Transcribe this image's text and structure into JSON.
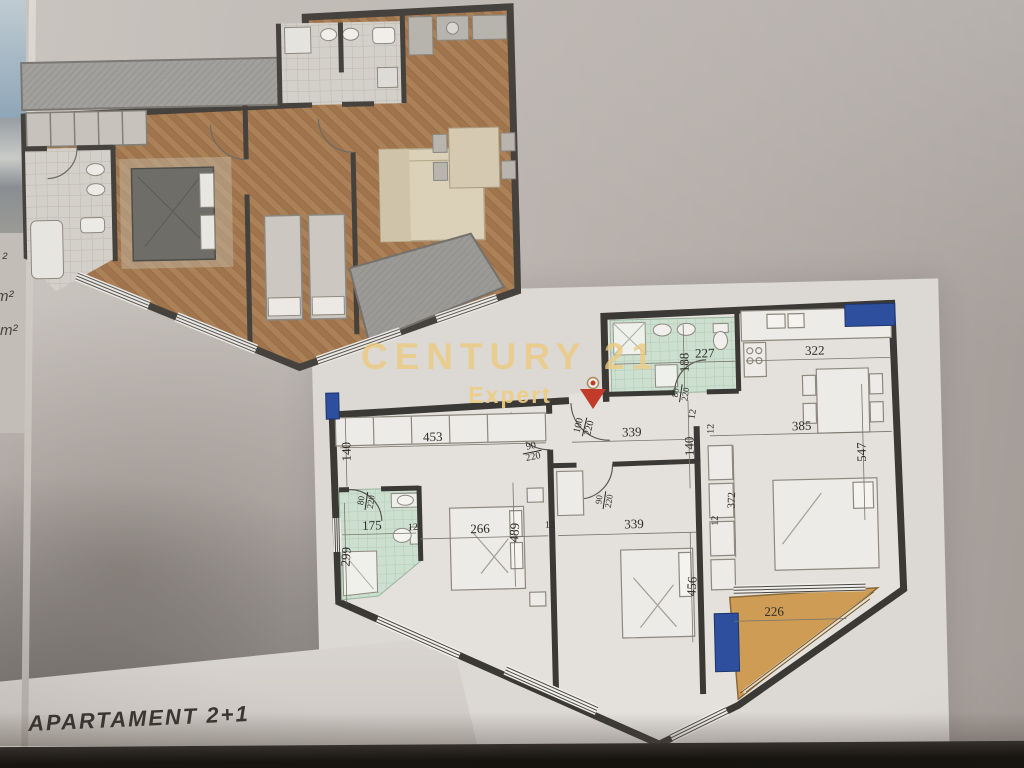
{
  "watermark": {
    "brand": "CENTURY 21",
    "sub": "Expert"
  },
  "caption": "APARTAMENT 2+1",
  "margin_labels": [
    {
      "t": "²",
      "x": 2,
      "y": 250
    },
    {
      "t": "m²",
      "x": -4,
      "y": 288
    },
    {
      "t": "m²",
      "x": 0,
      "y": 322
    }
  ],
  "colors": {
    "watermark_gold": "#eccb80",
    "logo_red": "#c13a2a",
    "marker_blue": "#2e4f9e",
    "balcony_tan": "#cf9c55",
    "bathroom_green": "#cde0d0",
    "wall_dark": "#3b3936",
    "wood_floor": "#ab8158"
  },
  "lower_plan": {
    "labels": [
      {
        "t": "453",
        "x": 113,
        "y": 134
      },
      {
        "t": "140",
        "x": 26,
        "y": 147,
        "r": -90
      },
      {
        "t": "90",
        "b": "220",
        "x": 212,
        "y": 152,
        "r": -10,
        "s": 10
      },
      {
        "t": "100",
        "b": "220",
        "x": 265,
        "y": 128,
        "r": -75,
        "s": 10
      },
      {
        "t": "339",
        "x": 312,
        "y": 134
      },
      {
        "t": "140",
        "x": 369,
        "y": 150,
        "r": -90
      },
      {
        "t": "12",
        "x": 392,
        "y": 133,
        "r": -90,
        "s": 10
      },
      {
        "t": "227",
        "x": 387,
        "y": 57
      },
      {
        "t": "188",
        "x": 366,
        "y": 66,
        "r": -90
      },
      {
        "t": "80",
        "b": "220",
        "x": 362,
        "y": 97,
        "r": -80,
        "s": 9
      },
      {
        "t": "12",
        "x": 374,
        "y": 118,
        "r": -80,
        "s": 10
      },
      {
        "t": "322",
        "x": 497,
        "y": 57
      },
      {
        "t": "385",
        "x": 482,
        "y": 132
      },
      {
        "t": "547",
        "x": 541,
        "y": 160,
        "r": -90
      },
      {
        "t": "372",
        "x": 411,
        "y": 205,
        "r": -87,
        "s": 11
      },
      {
        "t": "339",
        "x": 312,
        "y": 226
      },
      {
        "t": "90",
        "b": "220",
        "x": 283,
        "y": 202,
        "r": -80,
        "s": 9
      },
      {
        "t": "456",
        "x": 368,
        "y": 290,
        "r": -85
      },
      {
        "t": "266",
        "x": 158,
        "y": 227
      },
      {
        "t": "489",
        "x": 192,
        "y": 232,
        "r": -85
      },
      {
        "t": "175",
        "x": 50,
        "y": 221
      },
      {
        "t": "299",
        "x": 23,
        "y": 252,
        "r": -85
      },
      {
        "t": "80",
        "b": "220",
        "x": 45,
        "y": 197,
        "r": -80,
        "s": 9
      },
      {
        "t": "226",
        "x": 450,
        "y": 317
      },
      {
        "t": "12",
        "x": 91,
        "y": 225,
        "s": 10
      },
      {
        "t": "12",
        "x": 228,
        "y": 226,
        "s": 10
      },
      {
        "t": "12",
        "x": 394,
        "y": 225,
        "r": -90,
        "s": 10
      }
    ]
  }
}
